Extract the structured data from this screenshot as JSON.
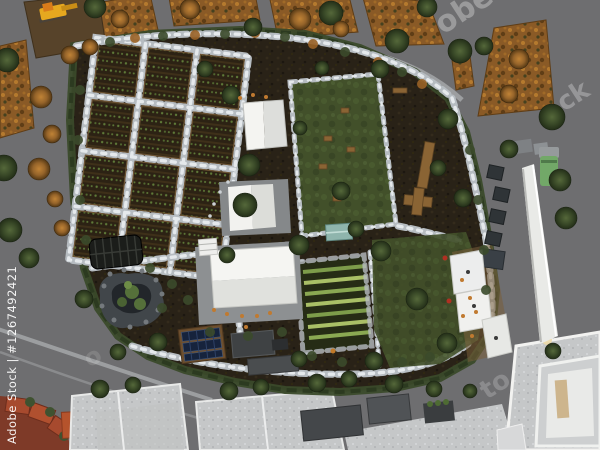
{
  "meta": {
    "kind": "watermarked stock 3D aerial render",
    "subject": "Top-down aerial 3D render of a community garden block with raised vegetable beds, white event tents, stone-lined lawns, pond, greenhouses, solar panels, autumn allotment plots and surrounding streets and rooftops",
    "width_px": 600,
    "height_px": 450
  },
  "watermarks": {
    "side_label": "Adobe Stock | #1267492421",
    "fragment_top_right": "obe",
    "fragment_right": "ck",
    "fragment_bottom_right": "to",
    "fragment_bottom_left": "o"
  },
  "palette": {
    "street_gray": "#6e6e70",
    "soil_dark": "#292217",
    "lawn_green": "#42502a",
    "stone_path": "#cdd2d6",
    "hedge_green": "#3a4a2a",
    "tent_white": "#f2f2ef",
    "autumn_orange": "#8a5a26",
    "tree_green": "#3a4a28",
    "solar_blue": "#16233c",
    "wood_brown": "#8a6434",
    "roof_light_gray": "#c5c7c8",
    "roof_dark_gray": "#44474a",
    "wall_white": "#e9eae7",
    "brick_red": "#a74a2e",
    "truck_green": "#72a868",
    "excavator_yellow": "#e6a81f",
    "greenhouse_teal": "#8fb5ad"
  }
}
